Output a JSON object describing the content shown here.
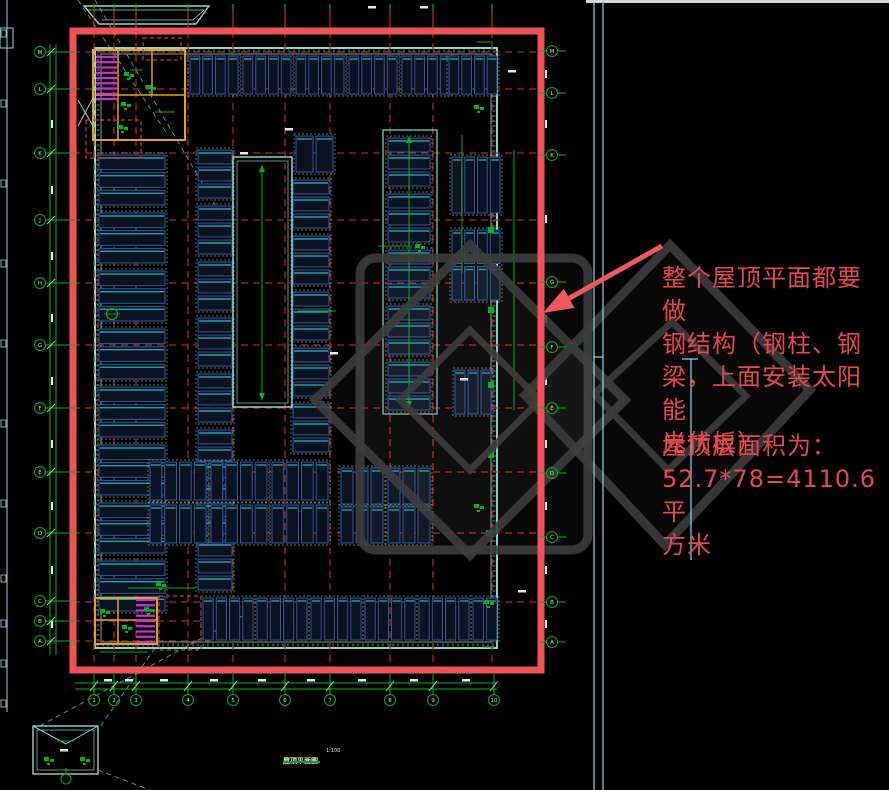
{
  "canvas": {
    "w": 889,
    "h": 790,
    "bg": "#000000"
  },
  "annotation": {
    "note_text": "整个屋顶平面都要做\n钢结构（钢柱、钢\n梁，上面安装太阳能\n光伏板）",
    "area_text": "屋顶层面积为：\n52.7*78=4110.6平\n方米",
    "color": "#e5494e"
  },
  "title_block": {
    "title": "屋顶平面图",
    "scale": "1:100"
  },
  "colors": {
    "border": "#ef5257",
    "grid": "#b42626",
    "wall": "#8fd4c8",
    "dim": "#00b41e",
    "bubble_text": "#c8eec8",
    "panel_fill": "#0b1322",
    "panel_stroke": "#2c5ca0",
    "panel_accent": "#1fa0ae",
    "group_stroke": "#8e8e8e",
    "stair_yellow": "#e2a41e",
    "stair_magenta": "#cc2fd4",
    "watermark": "#3d3d3d",
    "arrow": "#ed5a5e",
    "cyan": "#8fd8ea",
    "white": "#e8e8e8",
    "leader": "#5f9e92",
    "cloud": "#d03838"
  },
  "plan": {
    "border": {
      "x": 73,
      "y": 31,
      "w": 468,
      "h": 639,
      "stroke_w": 7
    },
    "wall": {
      "x": 95,
      "y": 48,
      "w": 402,
      "h": 600
    },
    "grid": {
      "verticals": [
        94,
        114,
        136,
        188,
        233,
        285,
        330,
        390,
        433,
        492
      ],
      "horizontals": [
        52,
        89,
        153,
        220,
        283,
        345,
        408,
        472,
        533,
        602
      ],
      "horizontals_partial": [
        621,
        641
      ]
    },
    "axes": {
      "left": {
        "x": 40,
        "ys": [
          52,
          89,
          153,
          220,
          283,
          345,
          408,
          472,
          533,
          601,
          621,
          641
        ],
        "labels": [
          "M",
          "L",
          "K",
          "J",
          "H",
          "G",
          "F",
          "E",
          "D",
          "C",
          "B",
          "A"
        ]
      },
      "right": {
        "x": 552,
        "ys": [
          51,
          93,
          155,
          282,
          347,
          408,
          473,
          537,
          602,
          642
        ],
        "labels": [
          "M",
          "L",
          "K",
          "G",
          "F",
          "E",
          "D",
          "C",
          "B",
          "A"
        ]
      },
      "bottom": {
        "y": 700,
        "xs": [
          94,
          114,
          136,
          188,
          233,
          285,
          330,
          390,
          433,
          494
        ],
        "labels": [
          "1",
          "2",
          "3",
          "4",
          "5",
          "6",
          "7",
          "8",
          "9",
          "10"
        ]
      }
    },
    "panel_groups": [
      [
        190,
        56,
        48,
        38,
        4,
        1
      ],
      [
        243,
        56,
        48,
        38,
        4,
        1
      ],
      [
        296,
        56,
        48,
        38,
        4,
        1
      ],
      [
        349,
        56,
        48,
        38,
        4,
        1
      ],
      [
        402,
        56,
        48,
        38,
        4,
        1
      ],
      [
        449,
        56,
        48,
        38,
        4,
        1
      ],
      [
        99,
        155,
        66,
        50,
        1,
        3
      ],
      [
        99,
        213,
        66,
        50,
        1,
        3
      ],
      [
        99,
        271,
        66,
        50,
        1,
        3
      ],
      [
        99,
        329,
        66,
        50,
        1,
        3
      ],
      [
        99,
        387,
        66,
        50,
        1,
        3
      ],
      [
        99,
        445,
        66,
        50,
        1,
        3
      ],
      [
        99,
        503,
        66,
        50,
        1,
        3
      ],
      [
        99,
        561,
        66,
        50,
        1,
        3
      ],
      [
        198,
        150,
        34,
        48,
        1,
        3
      ],
      [
        198,
        206,
        34,
        48,
        1,
        3
      ],
      [
        198,
        262,
        34,
        48,
        1,
        3
      ],
      [
        198,
        318,
        34,
        48,
        1,
        3
      ],
      [
        198,
        374,
        34,
        48,
        1,
        3
      ],
      [
        198,
        430,
        34,
        48,
        1,
        3
      ],
      [
        198,
        486,
        34,
        48,
        1,
        3
      ],
      [
        198,
        542,
        34,
        48,
        1,
        3
      ],
      [
        293,
        180,
        36,
        48,
        1,
        3
      ],
      [
        293,
        236,
        36,
        48,
        1,
        3
      ],
      [
        293,
        292,
        36,
        48,
        1,
        3
      ],
      [
        293,
        348,
        36,
        48,
        1,
        3
      ],
      [
        293,
        404,
        36,
        48,
        1,
        3
      ],
      [
        296,
        136,
        37,
        36,
        2,
        1
      ],
      [
        388,
        138,
        42,
        48,
        1,
        3
      ],
      [
        388,
        194,
        42,
        48,
        1,
        3
      ],
      [
        388,
        250,
        42,
        48,
        1,
        3
      ],
      [
        388,
        306,
        42,
        48,
        1,
        3
      ],
      [
        388,
        362,
        42,
        48,
        1,
        3
      ],
      [
        452,
        157,
        48,
        56,
        4,
        1
      ],
      [
        452,
        230,
        48,
        70,
        4,
        2
      ],
      [
        455,
        370,
        36,
        44,
        3,
        1
      ],
      [
        150,
        462,
        56,
        38,
        4,
        1
      ],
      [
        211,
        462,
        56,
        38,
        4,
        1
      ],
      [
        272,
        462,
        56,
        38,
        4,
        1
      ],
      [
        150,
        505,
        56,
        38,
        4,
        1
      ],
      [
        211,
        505,
        56,
        38,
        4,
        1
      ],
      [
        272,
        505,
        56,
        38,
        4,
        1
      ],
      [
        341,
        468,
        42,
        36,
        3,
        1
      ],
      [
        388,
        468,
        42,
        36,
        3,
        1
      ],
      [
        341,
        507,
        42,
        36,
        3,
        1
      ],
      [
        388,
        507,
        42,
        36,
        3,
        1
      ],
      [
        203,
        598,
        50,
        42,
        4,
        1
      ],
      [
        257,
        598,
        50,
        42,
        4,
        1
      ],
      [
        311,
        598,
        50,
        42,
        4,
        1
      ],
      [
        365,
        598,
        50,
        42,
        4,
        1
      ],
      [
        419,
        598,
        50,
        42,
        4,
        1
      ],
      [
        473,
        598,
        24,
        42,
        2,
        1
      ]
    ],
    "atrium": {
      "x": 233,
      "y": 157,
      "w": 59,
      "h": 250
    },
    "shaft": {
      "x": 383,
      "y": 130,
      "w": 54,
      "h": 284
    },
    "centerlines": [
      [
        262,
        165,
        262,
        400
      ],
      [
        409,
        136,
        409,
        408
      ]
    ],
    "stair_top": {
      "rect": [
        93,
        50,
        92,
        90
      ],
      "v1": 118,
      "v2": 152,
      "h1": 95,
      "stair": [
        96,
        57,
        21,
        42
      ]
    },
    "stair_bottom": {
      "rect": [
        95,
        598,
        62,
        46
      ],
      "v1": 118,
      "h1": 620,
      "stair": [
        136,
        600,
        19,
        42
      ]
    },
    "clouds": [
      [
        143,
        38,
        38,
        22
      ],
      [
        86,
        120,
        55,
        38
      ],
      [
        159,
        596,
        42,
        54
      ]
    ],
    "detail_box": {
      "outer": [
        33,
        726,
        65,
        48
      ],
      "inner": [
        37,
        730,
        57,
        40
      ],
      "flap": [
        [
          33,
          726,
          66,
          744
        ],
        [
          66,
          744,
          98,
          726
        ]
      ],
      "bubble": [
        66,
        779
      ]
    },
    "leaders": [
      [
        78,
        0,
        168,
        135
      ],
      [
        95,
        0,
        215,
        205
      ],
      [
        250,
        612,
        36,
        728
      ],
      [
        155,
        648,
        97,
        731
      ],
      [
        98,
        770,
        150,
        790
      ]
    ],
    "green_lines": [
      [
        298,
        311,
        336,
        311
      ],
      [
        378,
        246,
        412,
        246
      ],
      [
        462,
        135,
        462,
        273
      ],
      [
        128,
        588,
        196,
        588
      ],
      [
        130,
        70,
        143,
        70
      ],
      [
        155,
        112,
        175,
        112
      ],
      [
        477,
        42,
        493,
        42
      ],
      [
        483,
        647,
        495,
        647
      ],
      [
        100,
        652,
        148,
        652
      ],
      [
        514,
        150,
        514,
        410
      ]
    ],
    "green_clusters": [
      [
        419,
        247
      ],
      [
        478,
        108
      ],
      [
        478,
        507
      ],
      [
        128,
        75
      ],
      [
        150,
        88
      ],
      [
        125,
        105
      ],
      [
        122,
        128
      ],
      [
        104,
        612
      ],
      [
        126,
        628
      ],
      [
        148,
        610
      ],
      [
        488,
        603
      ],
      [
        160,
        585
      ],
      [
        48,
        760
      ],
      [
        84,
        760
      ]
    ],
    "green_squares": [
      [
        491,
        230
      ],
      [
        491,
        310
      ],
      [
        491,
        385
      ],
      [
        491,
        455
      ],
      [
        489,
        533
      ]
    ],
    "circle_marks": [
      [
        112,
        314
      ]
    ],
    "white_v": [
      [
        51,
        120
      ],
      [
        51,
        186
      ],
      [
        51,
        252
      ],
      [
        51,
        314
      ],
      [
        51,
        377
      ],
      [
        51,
        440
      ],
      [
        51,
        502
      ],
      [
        51,
        566
      ],
      [
        51,
        620
      ],
      [
        545,
        70
      ],
      [
        545,
        120
      ],
      [
        545,
        215
      ],
      [
        545,
        315
      ],
      [
        545,
        377
      ],
      [
        545,
        440
      ],
      [
        545,
        502
      ],
      [
        545,
        566
      ],
      [
        545,
        620
      ]
    ],
    "white_h": [
      [
        104,
        679
      ],
      [
        125,
        679
      ],
      [
        160,
        679
      ],
      [
        210,
        679
      ],
      [
        258,
        679
      ],
      [
        307,
        679
      ],
      [
        358,
        679
      ],
      [
        410,
        679
      ],
      [
        462,
        679
      ],
      [
        240,
        152
      ],
      [
        330,
        352
      ],
      [
        460,
        378
      ],
      [
        508,
        70
      ],
      [
        518,
        590
      ],
      [
        285,
        128
      ],
      [
        368,
        6
      ],
      [
        420,
        6
      ],
      [
        60,
        749
      ]
    ]
  },
  "frame": {
    "left_line": [
      7,
      0,
      7,
      712
    ],
    "left_glyphs": [
      30,
      100,
      180,
      260,
      340,
      420,
      500,
      575,
      620,
      660,
      700
    ],
    "corner_box": [
      0,
      28,
      13,
      20
    ],
    "top_strip": [
      586,
      0,
      303,
      3
    ],
    "trapezoid_outer": [
      [
        84,
        6
      ],
      [
        209,
        6
      ],
      [
        196,
        24
      ],
      [
        99,
        24
      ]
    ],
    "trapezoid_inner": [
      [
        88,
        10
      ],
      [
        204,
        10
      ],
      [
        193,
        20
      ],
      [
        102,
        20
      ]
    ],
    "cyan_lines": [
      [
        594,
        0,
        594,
        790
      ],
      [
        603,
        0,
        603,
        790
      ],
      [
        593,
        357,
        603,
        357
      ],
      [
        691,
        359,
        691,
        560
      ],
      [
        682,
        359,
        698,
        359
      ]
    ]
  },
  "watermark": {
    "rounded_square": [
      360,
      258,
      228,
      292
    ],
    "diamond1": [
      [
        470,
        245
      ],
      [
        625,
        400
      ],
      [
        470,
        555
      ],
      [
        315,
        400
      ]
    ],
    "diamond1_inner": [
      [
        470,
        330
      ],
      [
        540,
        400
      ],
      [
        470,
        470
      ],
      [
        400,
        400
      ]
    ],
    "diamond2": [
      [
        670,
        245
      ],
      [
        810,
        390
      ],
      [
        665,
        545
      ],
      [
        525,
        395
      ]
    ],
    "diamond2_inner": [
      [
        672,
        322
      ],
      [
        746,
        396
      ],
      [
        668,
        470
      ],
      [
        594,
        394
      ]
    ]
  },
  "arrow": {
    "tail": [
      662,
      246
    ],
    "tip": [
      543,
      313
    ]
  }
}
